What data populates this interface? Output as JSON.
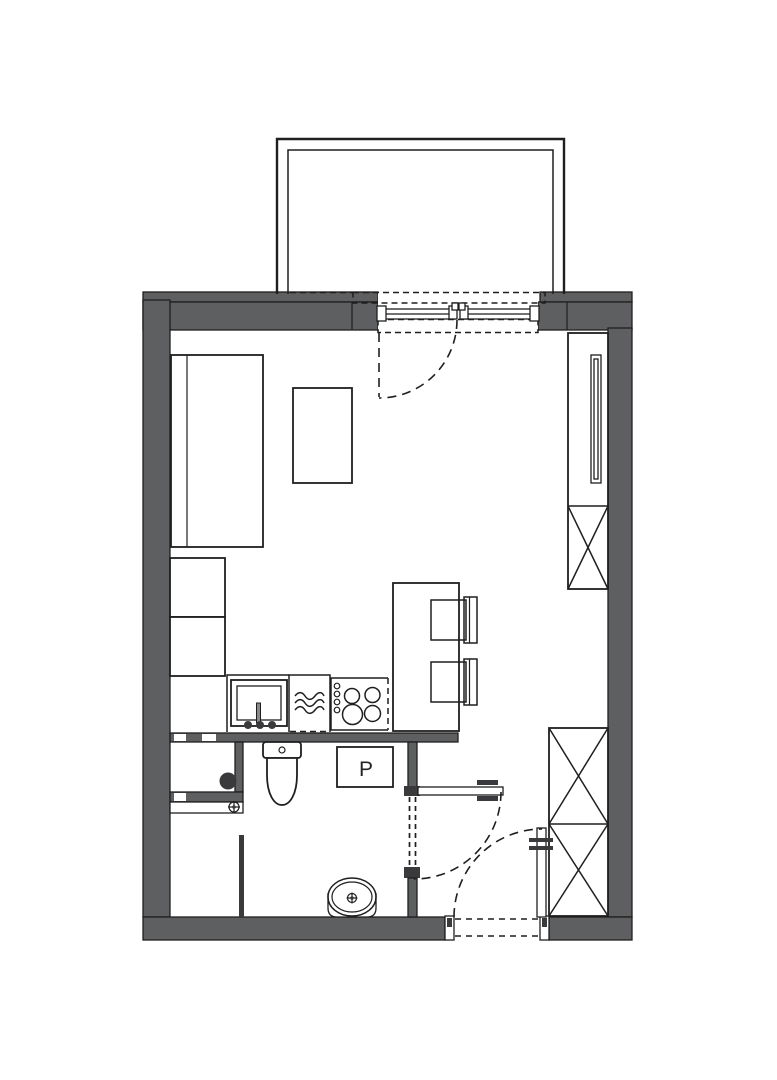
{
  "labels": {
    "washing_machine": "P"
  },
  "colors": {
    "wall": "#5e5f61",
    "line": "#1f1f1f",
    "background": "#ffffff",
    "fixture_dark": "#3a3a3c"
  },
  "fixtures": [
    "balcony",
    "balcony-door-window",
    "bed",
    "side-table",
    "kitchen-cabinets",
    "kitchen-sink",
    "dishwasher",
    "stove",
    "dining-peninsula",
    "chair",
    "tall-wardrobe",
    "hall-wardrobe",
    "utility-shaft",
    "water-meter-dot",
    "valve-symbol",
    "toilet",
    "washing-machine",
    "washbasin",
    "bathroom-door",
    "entry-door"
  ]
}
